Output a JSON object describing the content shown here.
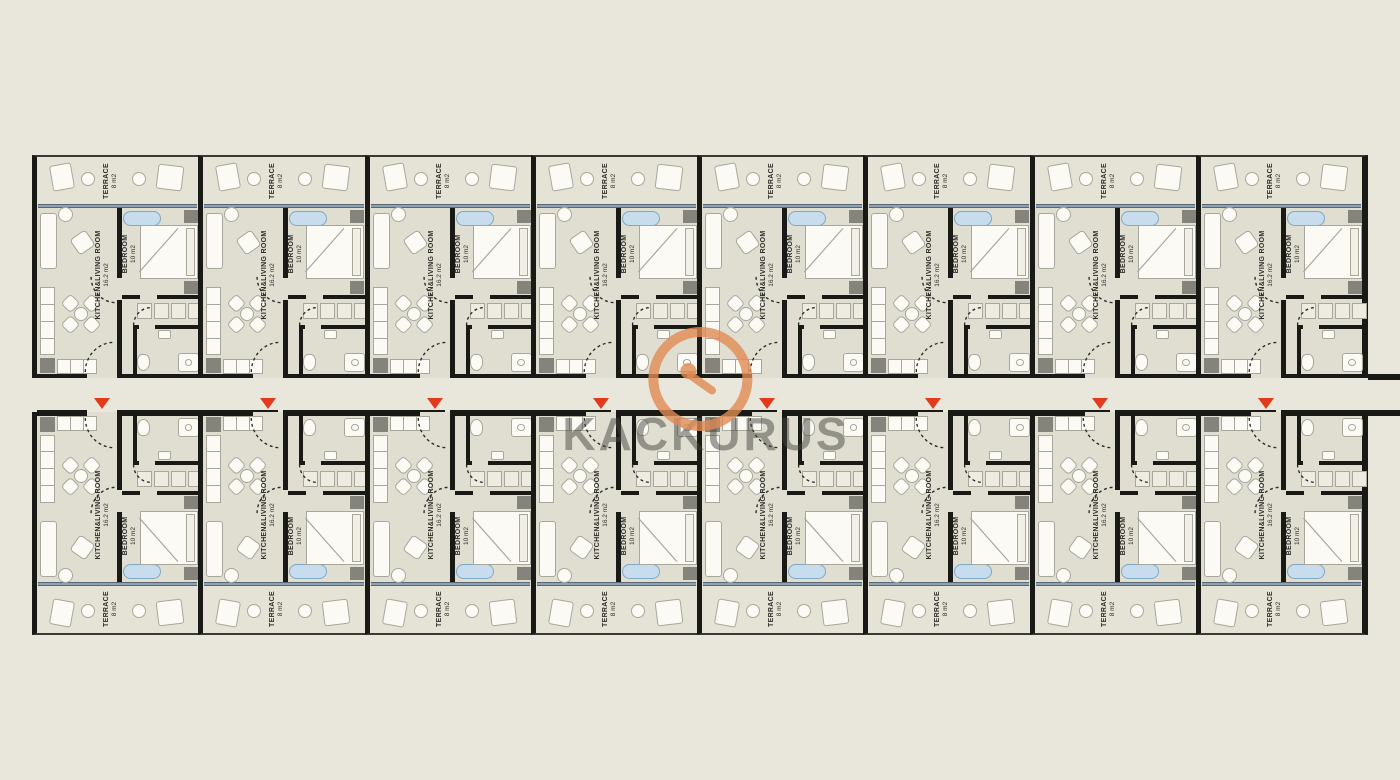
{
  "watermark": {
    "text": "KACKURUS",
    "logo": "ring-swoosh-logo"
  },
  "plan": {
    "rows": [
      "top",
      "bottom"
    ],
    "units_per_row": 8,
    "unit": {
      "terrace_label": "TERRACE",
      "terrace_area": "8 m2",
      "living_label": "KITCHEN&LIVING ROOM",
      "living_area": "16.2 m2",
      "bedroom_label": "BEDROOM",
      "bedroom_area": "10 m2"
    }
  },
  "colors": {
    "bg": "#e9e7db",
    "plan_fill": "#e0ded0",
    "terrace_fill": "#e5e3d5",
    "wall": "#191916",
    "furn_fill": "#fbfaf5",
    "furn_line": "#a9a79b",
    "dark_fixture": "#84847c",
    "glazing": "#8ba3b5",
    "tub_fill": "#c7dcec",
    "tub_line": "#7fa8c4",
    "marker": "#e23a1c",
    "label_ink": "#2f2f2a",
    "wm_text": "#46463f80",
    "wm_ring": "#e08b52cc"
  }
}
